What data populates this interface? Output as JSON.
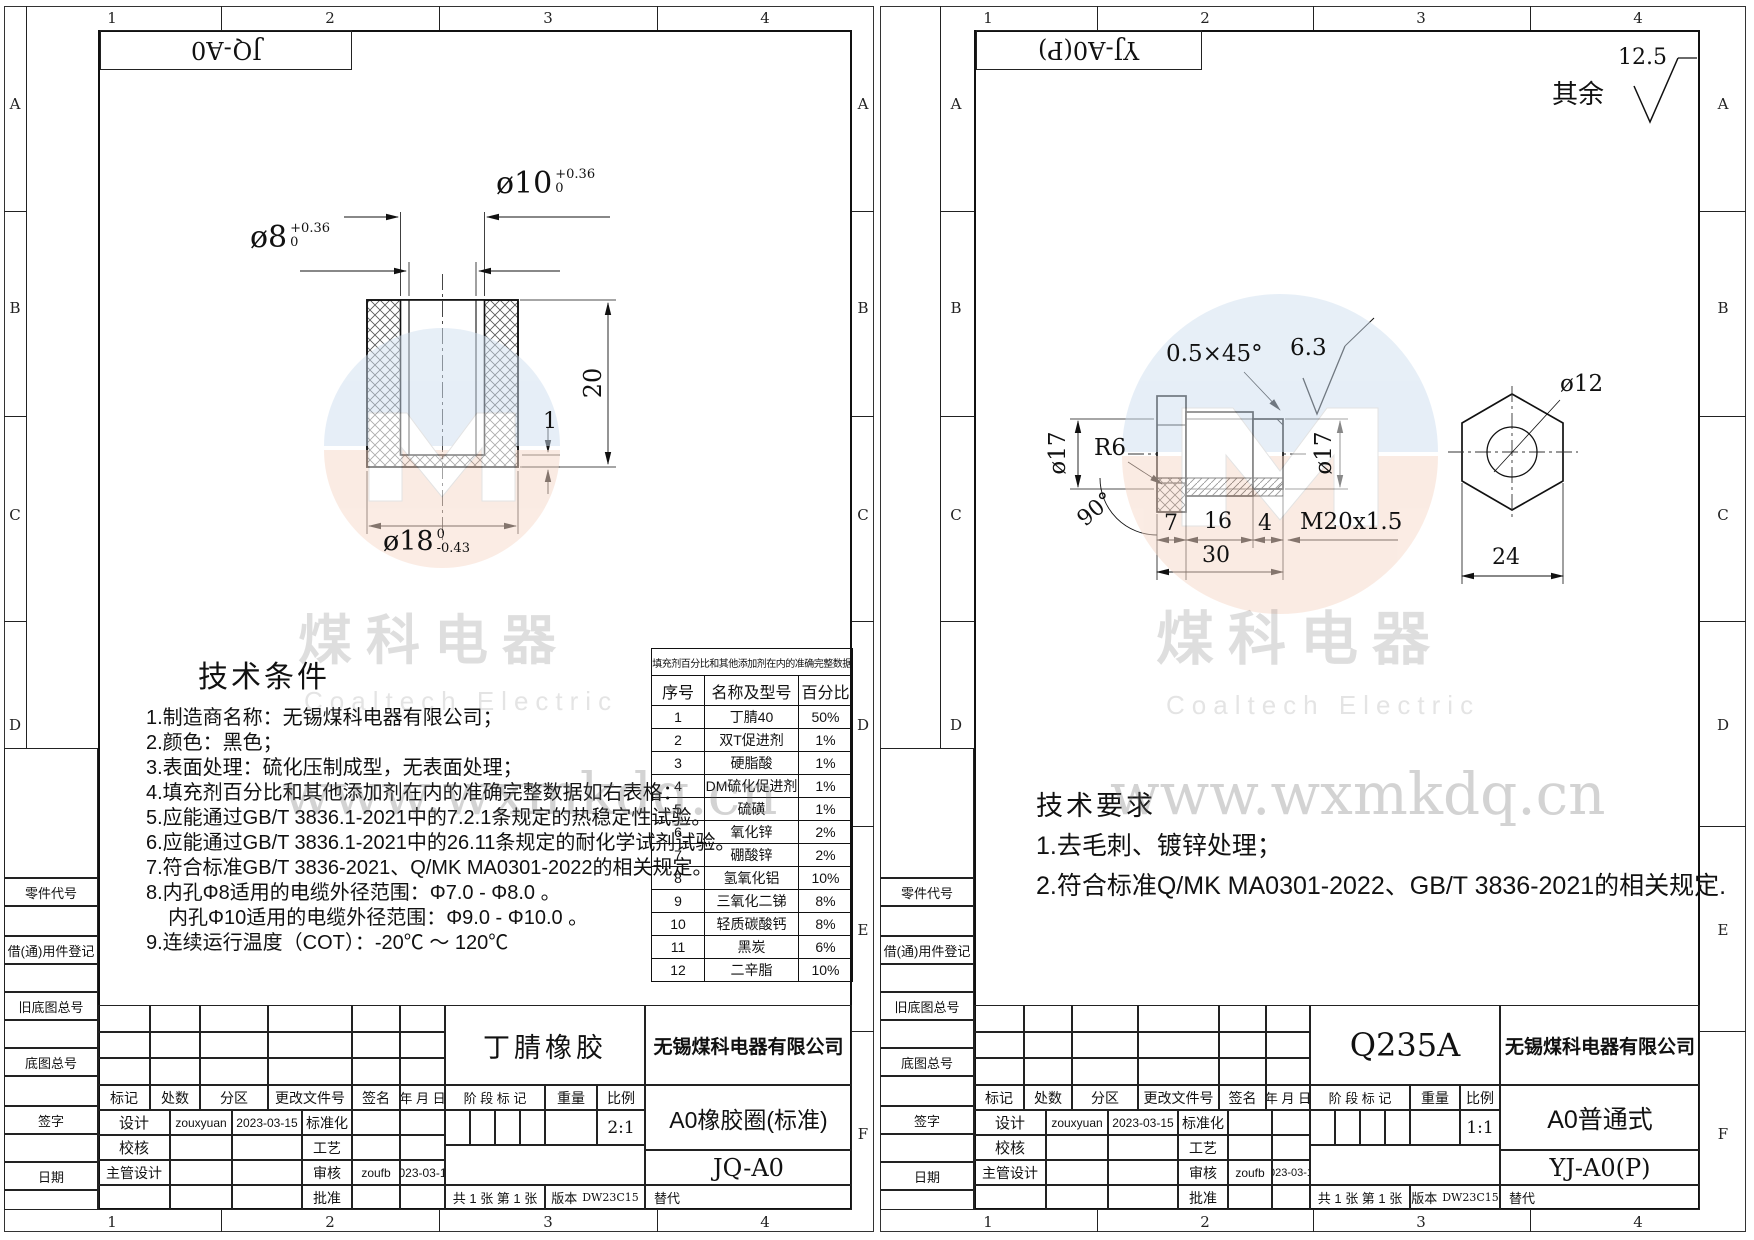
{
  "zones": {
    "cols": [
      "1",
      "2",
      "3",
      "4"
    ],
    "rows": [
      "A",
      "B",
      "C",
      "D",
      "E",
      "F"
    ]
  },
  "margin_labels": [
    "零件代号",
    "借(通)用件登记",
    "旧底图总号",
    "底图总号",
    "签字",
    "日期"
  ],
  "watermark": {
    "logo_cn": "煤科电器",
    "logo_en": "Coaltech Electric",
    "site": "www.wxmkdq.cn"
  },
  "titleblock": {
    "rev_headers": [
      "标记",
      "处数",
      "分区",
      "更改文件号",
      "签名",
      "年 月 日"
    ],
    "sign_rows": [
      [
        "设计",
        "zouxyuan",
        "2023-03-15",
        "标准化",
        "",
        ""
      ],
      [
        "校核",
        "",
        "",
        "工艺",
        "",
        ""
      ],
      [
        "主管设计",
        "",
        "",
        "审核",
        "zoufb",
        "2023-03-15"
      ],
      [
        "",
        "",
        "",
        "批准",
        "",
        ""
      ]
    ],
    "stage_label": "阶 段 标 记",
    "weight_label": "重量",
    "scale_label": "比例",
    "sheet_count": "共 1 张  第 1 张",
    "version_label": "版本",
    "version": "DW23C15",
    "replace_label": "替代"
  },
  "left_sheet": {
    "tab_code": "JQ-A0",
    "tech_title": "技术条件",
    "tech_notes": [
      "1.制造商名称：无锡煤科电器有限公司；",
      "2.颜色：黑色；",
      "3.表面处理：硫化压制成型，无表面处理；",
      "4.填充剂百分比和其他添加剂在内的准确完整数据如右表格：",
      "5.应能通过GB/T 3836.1-2021中的7.2.1条规定的热稳定性试验。",
      "6.应能通过GB/T 3836.1-2021中的26.11条规定的耐化学试剂试验。",
      "7.符合标准GB/T 3836-2021、Q/MK MA0301-2022的相关规定。",
      "8.内孔Φ8适用的电缆外径范围：Φ7.0 - Φ8.0 。",
      "内孔Φ10适用的电缆外径范围：Φ9.0 - Φ10.0 。",
      "9.连续运行温度（COT）：-20℃ ～ 120℃"
    ],
    "filler_table": {
      "title": "填充剂百分比和其他添加剂在内的准确完整数据",
      "headers": [
        "序号",
        "名称及型号",
        "百分比"
      ],
      "rows": [
        [
          "1",
          "丁腈40",
          "50%"
        ],
        [
          "2",
          "双T促进剂",
          "1%"
        ],
        [
          "3",
          "硬脂酸",
          "1%"
        ],
        [
          "4",
          "DM硫化促进剂",
          "1%"
        ],
        [
          "5",
          "硫磺",
          "1%"
        ],
        [
          "6",
          "氧化锌",
          "2%"
        ],
        [
          "7",
          "硼酸锌",
          "2%"
        ],
        [
          "8",
          "氢氧化铝",
          "10%"
        ],
        [
          "9",
          "三氧化二锑",
          "8%"
        ],
        [
          "10",
          "轻质碳酸钙",
          "8%"
        ],
        [
          "11",
          "黑炭",
          "6%"
        ],
        [
          "12",
          "二辛脂",
          "10%"
        ]
      ]
    },
    "dims": {
      "d10": "ø10",
      "d10_tol_top": "+0.36",
      "d10_tol_bot": "0",
      "d8": "ø8",
      "d8_tol_top": "+0.36",
      "d8_tol_bot": "0",
      "height": "20",
      "web": "1",
      "d18": "ø18",
      "d18_tol_top": "0",
      "d18_tol_bot": "-0.43"
    },
    "material": "丁腈橡胶",
    "company": "无锡煤科电器有限公司",
    "scale": "2:1",
    "product": "A0橡胶圈(标准)",
    "code": "JQ-A0"
  },
  "right_sheet": {
    "tab_code": "YJ-A0(P)",
    "surface": {
      "label": "其余",
      "value": "12.5",
      "local": "6.3"
    },
    "tech_title": "技术要求",
    "tech_notes": [
      "1.去毛刺、镀锌处理；",
      "2.符合标准Q/MK MA0301-2022、GB/T 3836-2021的相关规定."
    ],
    "dims": {
      "chamfer": "0.5×45°",
      "d17_left": "ø17",
      "r": "R6",
      "angle": "90°",
      "l7": "7",
      "l16": "16",
      "l4": "4",
      "l30": "30",
      "thread": "M20x1.5",
      "d17_right": "ø17",
      "d12": "ø12",
      "af": "24"
    },
    "material": "Q235A",
    "company": "无锡煤科电器有限公司",
    "scale": "1:1",
    "product": "A0普通式",
    "code": "YJ-A0(P)"
  }
}
